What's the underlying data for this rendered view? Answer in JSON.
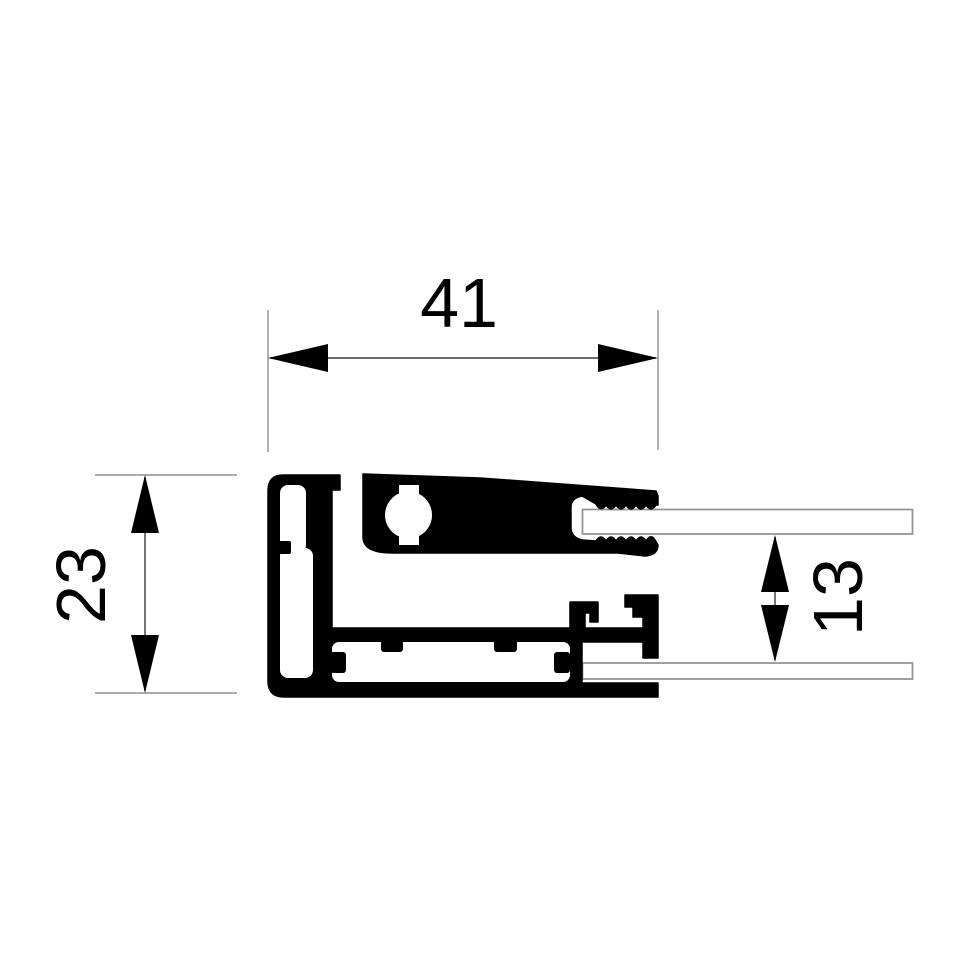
{
  "drawing": {
    "dimensions": {
      "width": {
        "label": "41"
      },
      "height": {
        "label": "23"
      },
      "panel_gap": {
        "label": "13"
      }
    },
    "colors": {
      "profile": "#000000",
      "panel_fill": "#ffffff",
      "panel_outline": "#969696",
      "extension_line": "#8f8f8f",
      "dimension_line": "#3a3a3a",
      "arrow": "#000000",
      "text": "#000000",
      "background": "#ffffff"
    }
  }
}
